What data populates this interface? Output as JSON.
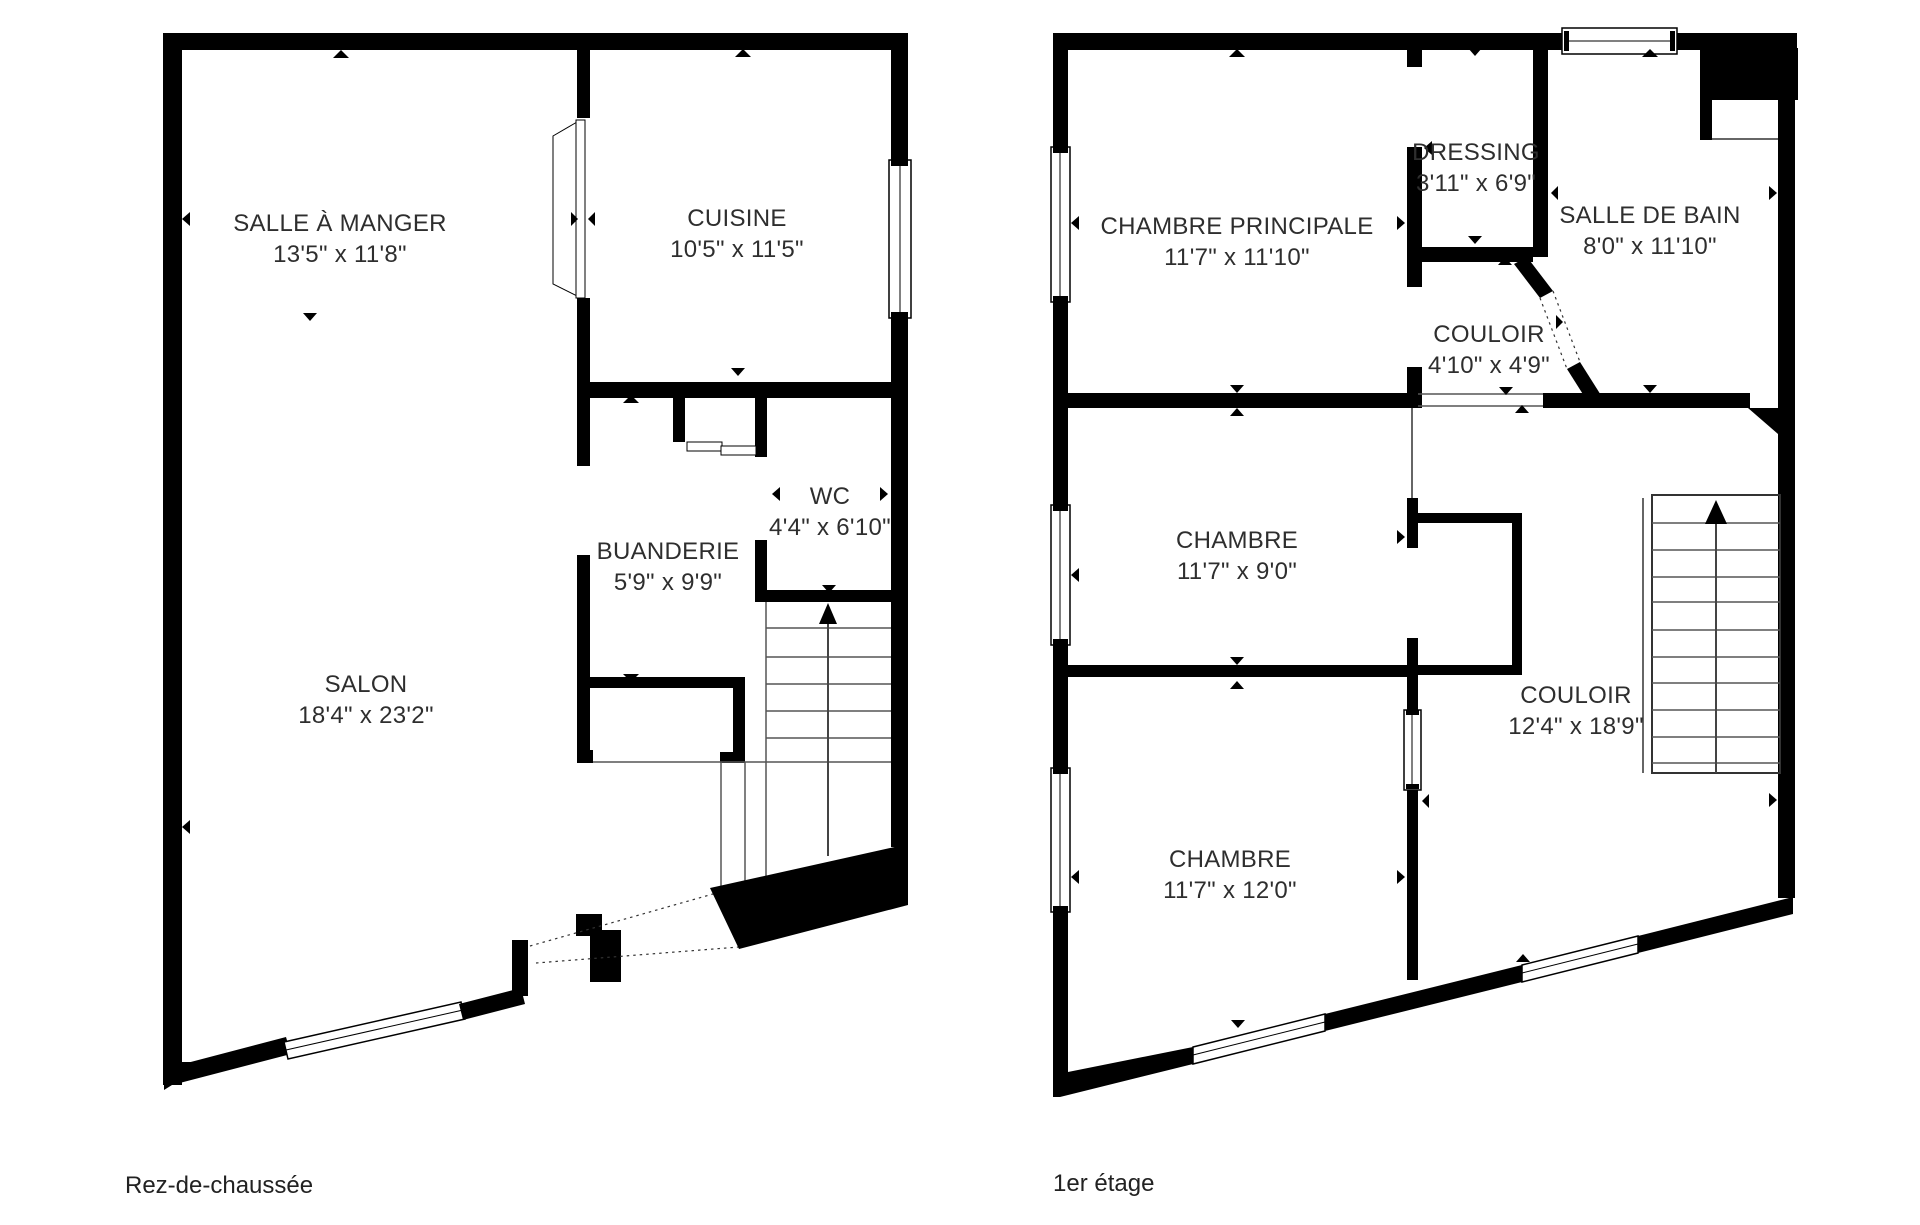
{
  "page": {
    "background": "#ffffff"
  },
  "colors": {
    "wall": "#000000",
    "text": "#2e2e2e",
    "stair_tread": "#555555"
  },
  "icons": {
    "stairs-up-arrow": "▲",
    "wall-direction-marker": "▲",
    "entry-door-path": "dotted-line"
  },
  "floors": [
    {
      "label": "Rez-de-chaussée",
      "rooms": [
        {
          "name": "SALLE À MANGER",
          "dims": "13'5\" x 11'8\""
        },
        {
          "name": "CUISINE",
          "dims": "10'5\" x 11'5\""
        },
        {
          "name": "BUANDERIE",
          "dims": "5'9\" x 9'9\""
        },
        {
          "name": "WC",
          "dims": "4'4\" x 6'10\""
        },
        {
          "name": "SALON",
          "dims": "18'4\" x 23'2\""
        }
      ]
    },
    {
      "label": "1er étage",
      "rooms": [
        {
          "name": "CHAMBRE PRINCIPALE",
          "dims": "11'7\" x 11'10\""
        },
        {
          "name": "DRESSING",
          "dims": "3'11\" x 6'9\""
        },
        {
          "name": "SALLE DE BAIN",
          "dims": "8'0\" x 11'10\""
        },
        {
          "name": "COULOIR",
          "dims": "4'10\" x 4'9\""
        },
        {
          "name": "CHAMBRE",
          "dims": "11'7\" x 9'0\""
        },
        {
          "name": "COULOIR",
          "dims": "12'4\" x 18'9\""
        },
        {
          "name": "CHAMBRE",
          "dims": "11'7\" x 12'0\""
        }
      ]
    }
  ]
}
